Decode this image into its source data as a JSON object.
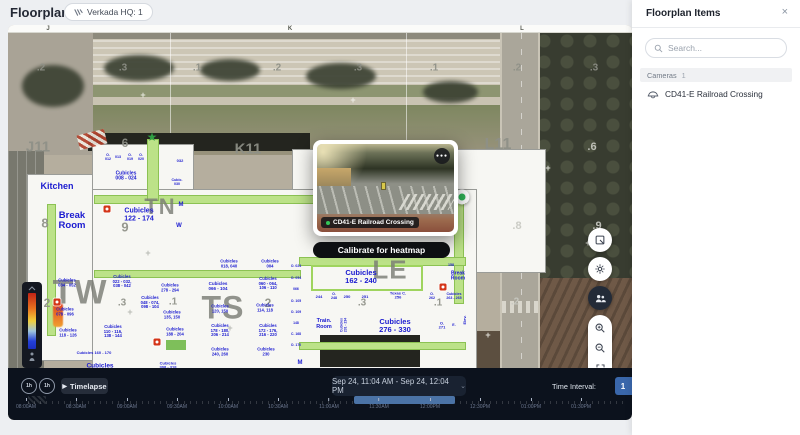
{
  "colors": {
    "accent_blue": "#3a67ab",
    "room_label_blue": "#1b1bd0",
    "hallway_green": "#bce288",
    "camera_green": "#2fb457",
    "heat_red": "#c22316",
    "timeline_highlight": "#4b73a6"
  },
  "page": {
    "title": "Floorplans",
    "site_chip": "Verkada HQ: 1"
  },
  "sidebar": {
    "title": "Floorplan Items",
    "close_icon": "×",
    "search_placeholder": "Search...",
    "section": {
      "label": "Cameras",
      "count": "1"
    },
    "items": [
      {
        "label": "CD41-E Railroad Crossing"
      }
    ]
  },
  "popup": {
    "camera_label": "CD41-E Railroad Crossing",
    "menu_icon": "●●●",
    "calibrate_button": "Calibrate for heatmap"
  },
  "timebar": {
    "rewind_label": "1h",
    "forward_label": "1h",
    "play_icon": "▶",
    "timelapse_label": "Timelapse",
    "range_label": "Sep 24, 11:04 AM  -  Sep 24, 12:04 PM",
    "chevron_icon": "⌄",
    "interval_label": "Time Interval:",
    "interval_value": "1",
    "ticks": [
      {
        "label": "08:00AM",
        "x": 18
      },
      {
        "label": "08:30AM",
        "x": 68
      },
      {
        "label": "09:00AM",
        "x": 119
      },
      {
        "label": "09:30AM",
        "x": 169
      },
      {
        "label": "10:00AM",
        "x": 220
      },
      {
        "label": "10:30AM",
        "x": 270
      },
      {
        "label": "11:00AM",
        "x": 321
      },
      {
        "label": "11:30AM",
        "x": 371
      },
      {
        "label": "12:00PM",
        "x": 422
      },
      {
        "label": "12:30PM",
        "x": 472
      },
      {
        "label": "01:00PM",
        "x": 523
      },
      {
        "label": "01:30PM",
        "x": 573
      }
    ]
  },
  "map": {
    "ruler_letters": [
      {
        "t": "J",
        "x": 40
      },
      {
        "t": "K",
        "x": 282
      },
      {
        "t": "L",
        "x": 514
      }
    ],
    "entrance_star": "★",
    "grid_labels": [
      {
        "t": "J11",
        "x": 30,
        "y": 122,
        "fs": 15
      },
      {
        "t": "K11",
        "x": 240,
        "y": 124,
        "fs": 15
      },
      {
        "t": "L11",
        "x": 490,
        "y": 120,
        "fs": 16
      },
      {
        "t": ".2",
        "x": 33,
        "y": 43,
        "fs": 10
      },
      {
        "t": ".3",
        "x": 115,
        "y": 43,
        "fs": 10
      },
      {
        "t": ".1",
        "x": 189,
        "y": 43,
        "fs": 10
      },
      {
        "t": ".2",
        "x": 269,
        "y": 43,
        "fs": 10
      },
      {
        "t": ".3",
        "x": 350,
        "y": 43,
        "fs": 10
      },
      {
        "t": ".1",
        "x": 426,
        "y": 43,
        "fs": 10
      },
      {
        "t": ".2",
        "x": 509,
        "y": 43,
        "fs": 10
      },
      {
        "t": ".3",
        "x": 586,
        "y": 43,
        "fs": 10
      },
      {
        "t": ".6",
        "x": 584,
        "y": 122,
        "fs": 11,
        "c": "#c8c9c2"
      },
      {
        "t": ".8",
        "x": 509,
        "y": 201,
        "fs": 11,
        "c": "#c8c9c2"
      },
      {
        "t": ".9",
        "x": 589,
        "y": 201,
        "fs": 11,
        "c": "#c8c9c2"
      },
      {
        "t": ".2",
        "x": 507,
        "y": 277,
        "fs": 10,
        "c": "#c8c9c2"
      },
      {
        "t": "6",
        "x": 117,
        "y": 118,
        "fs": 12
      },
      {
        "t": "8",
        "x": 37,
        "y": 198,
        "fs": 13
      },
      {
        "t": "9",
        "x": 117,
        "y": 202,
        "fs": 13
      },
      {
        "t": "2",
        "x": 39,
        "y": 278,
        "fs": 12
      },
      {
        "t": ".3",
        "x": 114,
        "y": 278,
        "fs": 10
      },
      {
        "t": ".1",
        "x": 165,
        "y": 277,
        "fs": 10
      },
      {
        "t": "2",
        "x": 260,
        "y": 278,
        "fs": 12
      },
      {
        "t": ".3",
        "x": 354,
        "y": 278,
        "fs": 10
      },
      {
        "t": ".1",
        "x": 430,
        "y": 278,
        "fs": 10
      }
    ],
    "watermarks": [
      {
        "t": "TW",
        "x": 72,
        "y": 268,
        "fs": 34
      },
      {
        "t": "TS",
        "x": 215,
        "y": 283,
        "fs": 32
      },
      {
        "t": "LE",
        "x": 382,
        "y": 245,
        "fs": 26
      },
      {
        "t": "TN",
        "x": 152,
        "y": 182,
        "fs": 22
      }
    ],
    "room_labels": [
      {
        "t": "Kitchen",
        "x": 49,
        "y": 162,
        "fs": 9
      },
      {
        "t": "Break\nRoom",
        "x": 64,
        "y": 196,
        "fs": 9.5
      },
      {
        "t": "O.\n012",
        "x": 100,
        "y": 133,
        "fs": 3.6
      },
      {
        "t": "013",
        "x": 110,
        "y": 133,
        "fs": 3.6
      },
      {
        "t": "O.\n019",
        "x": 122,
        "y": 133,
        "fs": 3.6
      },
      {
        "t": "O.\n020",
        "x": 133,
        "y": 133,
        "fs": 3.6
      },
      {
        "t": "032",
        "x": 172,
        "y": 136,
        "fs": 4
      },
      {
        "t": "Cubic.\n030",
        "x": 169,
        "y": 158,
        "fs": 3.6
      },
      {
        "t": "Cubicles\n008 - 024",
        "x": 118,
        "y": 152,
        "fs": 5
      },
      {
        "t": "Cubicles\n122 - 174",
        "x": 131,
        "y": 190,
        "fs": 7
      },
      {
        "t": "M",
        "x": 173,
        "y": 180,
        "fs": 6
      },
      {
        "t": "W",
        "x": 171,
        "y": 201,
        "fs": 6
      },
      {
        "t": "Cubicles\n018, 040",
        "x": 221,
        "y": 239,
        "fs": 4.2
      },
      {
        "t": "Cubicles\n004",
        "x": 262,
        "y": 239,
        "fs": 4.2
      },
      {
        "t": "Cubicles\n066 - 104",
        "x": 210,
        "y": 262,
        "fs": 4.5
      },
      {
        "t": "Cubicles\n060 - 064,\n106 - 110",
        "x": 260,
        "y": 259,
        "fs": 4.2
      },
      {
        "t": "Cubicles\n114, 118",
        "x": 257,
        "y": 283,
        "fs": 4.2
      },
      {
        "t": "Cubicles\n120, 150",
        "x": 212,
        "y": 284,
        "fs": 4.2
      },
      {
        "t": "Cubicles\n178 - 180,\n206 - 214",
        "x": 212,
        "y": 306,
        "fs": 4.2
      },
      {
        "t": "Cubicles\n172 - 176,\n216 - 220",
        "x": 260,
        "y": 306,
        "fs": 4.2
      },
      {
        "t": "Cubicles\n240, 260",
        "x": 212,
        "y": 327,
        "fs": 4.2
      },
      {
        "t": "Cubicles\n230",
        "x": 258,
        "y": 327,
        "fs": 4.2
      },
      {
        "t": "Cubicles\n034 - 052",
        "x": 59,
        "y": 258,
        "fs": 4.2
      },
      {
        "t": "Cubicles\n022 - 032,\n038 - 042",
        "x": 114,
        "y": 257,
        "fs": 4.2
      },
      {
        "t": "Cubicles\n078 - 096",
        "x": 57,
        "y": 287,
        "fs": 4.2
      },
      {
        "t": "Cubicles\n048 - 074,\n098 - 104",
        "x": 142,
        "y": 278,
        "fs": 4.2
      },
      {
        "t": "Cubicles\n278 - 294",
        "x": 162,
        "y": 263,
        "fs": 4.2
      },
      {
        "t": "Cubicles\n118 - 126",
        "x": 60,
        "y": 308,
        "fs": 4.2
      },
      {
        "t": "Cubicles\n110 - 116,\n138 - 144",
        "x": 105,
        "y": 307,
        "fs": 4.2
      },
      {
        "t": "Cubicles\n135, 150",
        "x": 164,
        "y": 290,
        "fs": 4.2
      },
      {
        "t": "Cubicles\n188 - 204",
        "x": 167,
        "y": 307,
        "fs": 4.2
      },
      {
        "t": "Cubicles 160 - 170",
        "x": 86,
        "y": 328,
        "fs": 4
      },
      {
        "t": "Cubicles",
        "x": 92,
        "y": 341,
        "fs": 6.5
      },
      {
        "t": "Cubicles\n308 - 318",
        "x": 160,
        "y": 341,
        "fs": 4
      },
      {
        "t": "Cubicles\n162 - 240",
        "x": 353,
        "y": 252,
        "fs": 7.5
      },
      {
        "t": "244",
        "x": 311,
        "y": 272,
        "fs": 4
      },
      {
        "t": "O.\n248",
        "x": 326,
        "y": 272,
        "fs": 3.6
      },
      {
        "t": "250",
        "x": 339,
        "y": 272,
        "fs": 4
      },
      {
        "t": "251",
        "x": 357,
        "y": 272,
        "fs": 4
      },
      {
        "t": "Texas C.\n256",
        "x": 390,
        "y": 271,
        "fs": 4
      },
      {
        "t": "O.\n262",
        "x": 424,
        "y": 272,
        "fs": 3.6
      },
      {
        "t": "Train.\nRoom",
        "x": 316,
        "y": 300,
        "fs": 5.5
      },
      {
        "t": "Cubicles\n231 - 234",
        "x": 336,
        "y": 300,
        "fs": 3.4,
        "rot": -90
      },
      {
        "t": "Cubicles\n276 - 330",
        "x": 387,
        "y": 301,
        "fs": 7.5
      },
      {
        "t": "O.\n271",
        "x": 434,
        "y": 301,
        "fs": 4
      },
      {
        "t": "E.",
        "x": 446,
        "y": 301,
        "fs": 3.6
      },
      {
        "t": "Elev.",
        "x": 457,
        "y": 295,
        "fs": 4,
        "rot": -90
      },
      {
        "t": "Break\nRoom",
        "x": 450,
        "y": 252,
        "fs": 5
      },
      {
        "t": "158",
        "x": 443,
        "y": 241,
        "fs": 3.6
      },
      {
        "t": "Cubicles\n263 - 265",
        "x": 446,
        "y": 272,
        "fs": 3.6
      },
      {
        "t": "O. 024",
        "x": 288,
        "y": 242,
        "fs": 3.4
      },
      {
        "t": "O. 054",
        "x": 288,
        "y": 254,
        "fs": 3.4
      },
      {
        "t": "066",
        "x": 288,
        "y": 265,
        "fs": 3.4
      },
      {
        "t": "O. 105",
        "x": 288,
        "y": 277,
        "fs": 3.4
      },
      {
        "t": "O. 109",
        "x": 288,
        "y": 288,
        "fs": 3.4
      },
      {
        "t": "148",
        "x": 288,
        "y": 299,
        "fs": 3.4
      },
      {
        "t": "C. 168",
        "x": 288,
        "y": 310,
        "fs": 3.4
      },
      {
        "t": "O. 170",
        "x": 288,
        "y": 321,
        "fs": 3.4
      },
      {
        "t": "M",
        "x": 292,
        "y": 338,
        "fs": 6
      }
    ],
    "plus_marks": [
      {
        "t": "+",
        "x": 135,
        "y": 70
      },
      {
        "t": "+",
        "x": 345,
        "y": 75
      },
      {
        "t": "+",
        "x": 540,
        "y": 143
      },
      {
        "t": "+",
        "x": 580,
        "y": 218
      },
      {
        "t": "+",
        "x": 480,
        "y": 310
      },
      {
        "t": "+",
        "x": 140,
        "y": 228,
        "c": "#b9bbb4"
      },
      {
        "t": "+",
        "x": 122,
        "y": 287,
        "c": "#b9bbb4"
      },
      {
        "t": "+",
        "x": 222,
        "y": 303,
        "c": "#b9bbb4"
      },
      {
        "t": "+",
        "x": 355,
        "y": 232,
        "c": "#b9bbb4"
      }
    ],
    "fire_markers": [
      {
        "x": 99,
        "y": 184
      },
      {
        "x": 49,
        "y": 277
      },
      {
        "x": 149,
        "y": 317
      },
      {
        "x": 435,
        "y": 262
      }
    ]
  }
}
